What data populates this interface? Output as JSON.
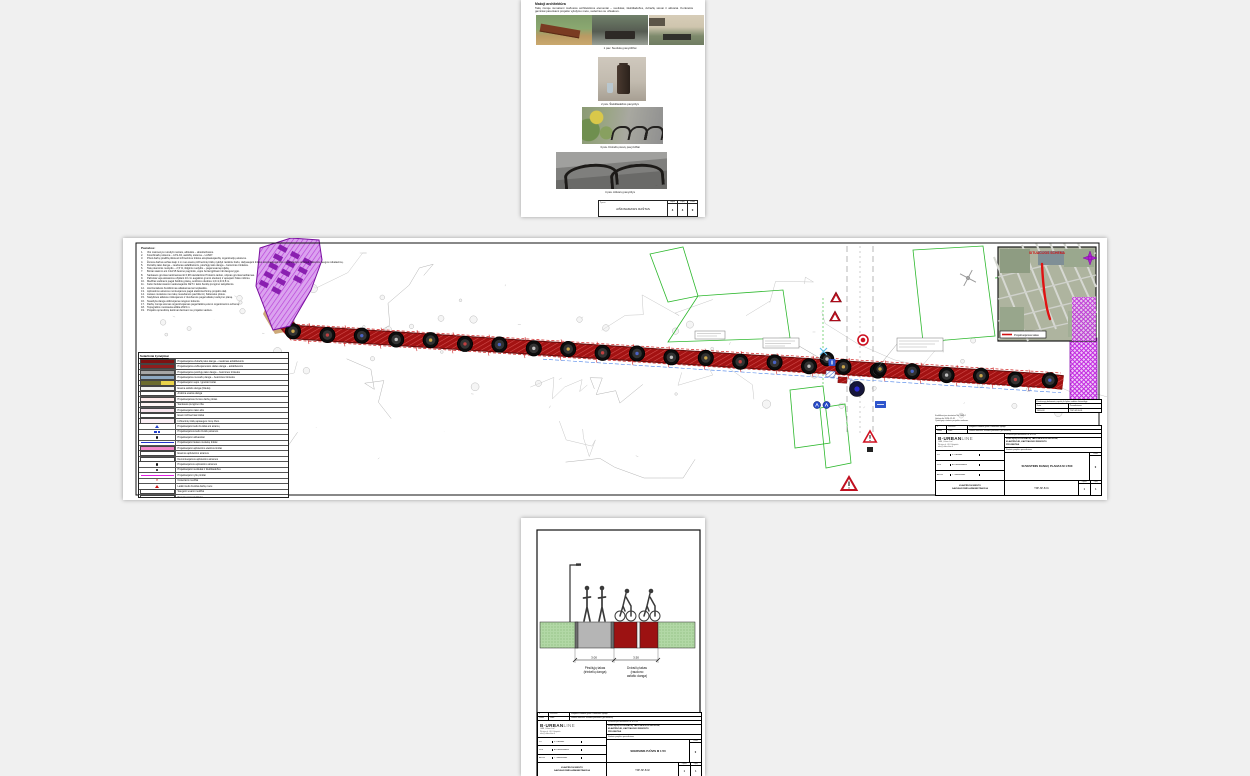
{
  "page1": {
    "heading": "Mažoji architektūra",
    "para": "Takų zonoje numatomi mažosios architektūros elementai – suoliukai, šiukšliadėžės, dviračių stovai ir atitvarai. Konkretūs gaminiai parenkami projekto vykdymo metu, suderinus su užsakovu.",
    "captions": [
      "1 pav. Suoliukų pavyzdžiai",
      "2 pav. Šiukšliadėžės pavyzdys",
      "3 pav. Dviračių stovų pavyzdžiai",
      "4 pav. Atitvarų pavyzdys"
    ],
    "footer": {
      "mark": "Žymuo",
      "doc": "AIŠKINAMASIS RAŠTAS",
      "cols": [
        {
          "k": "Lapas",
          "v": "4"
        },
        {
          "k": "Lapų",
          "v": "4"
        },
        {
          "k": "Laida",
          "v": "0"
        }
      ]
    }
  },
  "page2": {
    "notes_title": "Pastabos:",
    "notes": [
      "Visi matmenys nurodyti metrais, altitudės – absoliučiosios.",
      "Koordinačių sistema – LKS-94, aukščių sistema – LAS07.",
      "Prieš darbų pradžią iškviesti inžinerinius tinklus eksploatuojančių organizacijų atstovus.",
      "Žemės darbus arčiau kaip 1 m nuo esamų inžinerinių tinklų vykdyti rankiniu būdu, dalyvaujant tinklus eksploatuojančios organizacijos atstovui, laikantis saugos reikalavimų.",
      "Dviračių tako danga – raudonas asfaltbetonis, pėsčiųjų tako danga – betoninės trinkelės.",
      "Takų skersinis nuolydis – 2,5 %, išilginis nuolydis – pagal esamą reljefą.",
      "Bortai statomi ant C12/15 betono pagrindo, vejos bortai įgilinami iki dangos lygio.",
      "Sankasos gruntas tankinamas iki 0,98 standartinio Proktoro tankio, silpnas gruntas keičiamas.",
      "Pažeista veja atstatoma užpilant 10 cm augalinio grunto sluoksnį ir apsėjant žolės mišiniu.",
      "Medžiai sodinami pagal želdinių planą, sodinimo duobės 1,0×1,0×0,8 m.",
      "Kelio ženklai statomi vadovaujantis KET ir kelio ženklų įrengimo taisyklėmis.",
      "Horizontalusis ženklinimas atliekamas termoplastiku.",
      "Apšvietimo atramos montuojamos pagal elektrotechninę projekto dalį.",
      "Lietaus nuotekos nuo takų nuvedamos paviršiumi į žaliuosius plotus.",
      "Statybinės atliekos rūšiuojamos ir išvežamos pagal atliekų tvarkymo planą.",
      "Nuardyta danga utilizuojama rangovo lėšomis.",
      "Darbų zonoje eismas organizuojamas pagal laikiną eismo organizavimo schemą.",
      "Topografinė nuotrauka atlikta 2023 m.",
      "Projekto sprendinių keitimai derinami su projekto vadovu."
    ],
    "legend_title": "Sutartiniai žymėjimai",
    "legend": [
      {
        "y": "band",
        "c": "#7d1111",
        "t": "Projektuojama dviračių tako danga – raudonas asfaltbetonis"
      },
      {
        "y": "band",
        "c": "#8f1d1d",
        "t": "Projektuojama važiuojamosios dalies danga – asfaltbetonis"
      },
      {
        "y": "band",
        "c": "#a6a6a6",
        "t": "Projektuojama pėsčiųjų tako danga – betoninės trinkelės"
      },
      {
        "y": "band",
        "c": "#8fa9c2",
        "t": "Projektuojama nuovažų danga – betoninės trinkelės"
      },
      {
        "y": "split",
        "c": "#6b6b2f",
        "c2": "#e8d24a",
        "t": "Projektuojami vejos / granito bortai"
      },
      {
        "y": "band",
        "c": "#efefef",
        "t": "Esama asfalto danga (išlieka)"
      },
      {
        "y": "band",
        "c": "#ffffff",
        "t": "Ardoma esama danga"
      },
      {
        "y": "band",
        "c": "#fdeaea",
        "t": "Projektuojamas žemės darbų plotas"
      },
      {
        "y": "band",
        "c": "#fff4f4",
        "t": "Sankasos įrengimo riba"
      },
      {
        "y": "band",
        "c": "#f6e3ec",
        "t": "Projektuojamo tako ašis"
      },
      {
        "y": "band",
        "c": "#ffffff",
        "t": "Esami inžineriniai tinklai"
      },
      {
        "y": "band",
        "c": "#fbeff5",
        "t": "Inžinerinių tinklų apsaugos zonų ribos"
      },
      {
        "y": "btri",
        "t": "Projektuojami kelio ženklai ant atramų"
      },
      {
        "y": "bdots",
        "t": "Projektuojamos kelio ženklų atramos"
      },
      {
        "y": "dot",
        "t": "Projektuojami atitvarėliai"
      },
      {
        "y": "line",
        "c": "#2233cc",
        "t": "Projektuojami lietaus nuotekų tinklai"
      },
      {
        "y": "band",
        "c": "#f387c9",
        "t": "Projektuojami apšvietimo elektros tinklai"
      },
      {
        "y": "band",
        "c": "#ffffff",
        "t": "Esamos apšvietimo atramos"
      },
      {
        "y": "band",
        "c": "#ffffff",
        "t": "Demontuojamos apšvietimo atramos"
      },
      {
        "y": "dot",
        "t": "Projektuojamos apšvietimo atramos"
      },
      {
        "y": "dot",
        "t": "Projektuojami suoliukai ir šiukšliadėžės"
      },
      {
        "y": "line",
        "c": "#e020e0",
        "t": "Projektuojami ryšių tinklai"
      },
      {
        "y": "x",
        "t": "Nukertami medžiai"
      },
      {
        "y": "rtri",
        "t": "Laikini kelio ženklai darbų metu"
      },
      {
        "y": "band",
        "c": "#ffffff",
        "t": "Saugomi esami medžiai"
      },
      {
        "y": "band",
        "c": "#ffffff",
        "t": "Projektuojami želdiniai"
      },
      {
        "y": "line",
        "c": "#4ad84a",
        "t": "Projektuojama veja"
      },
      {
        "y": "rdash",
        "t": "Darbų zonos riba"
      },
      {
        "y": "band",
        "c": "#b45fe8",
        "t": "Griaunami / rekonstruojami statiniai"
      }
    ],
    "map": {
      "title": "SITUACIJOS SCHEMA",
      "legend": "Projektuojamas takas"
    },
    "attest_lines": [
      "Kvalifikacijos atestatas Nr. 26814",
      "Galioja iki 2026-12-31",
      "Ypatingojo statinio projekto vadovas"
    ],
    "minitable": {
      "title": "Privalomųjų dokumentų sąrašą žr. bylos sudėties žiniaraštyje",
      "h1": "Data",
      "h2": "Pavadinimas",
      "v1": "2024-03",
      "v2": "TDP-SP-B.01"
    },
    "tb": {
      "rev": "0",
      "rev_date": "2024-03",
      "rev_note": "Statybos leidimui gauti ir darbams vykdyti",
      "laida_h": "Laida",
      "data_h": "Data",
      "status_h": "Laidos statusas. Keitimo priežastis (jei taikoma)",
      "logo_a": "B·URBAN",
      "logo_b": "LINE",
      "addr": [
        "UAB „Urban line“",
        "Šilutės pl. 48, Klaipėda",
        "info@urbanline.lt"
      ],
      "attest": "Kvalifikacijos dokumento Nr. A 1234",
      "project": [
        "PĖSČIŲJŲ IR DVIRAČIŲ TAKO ALĖJOS GATVĖJE,",
        "KLAIPĖDOJE, KAPITALINIO REMONTO",
        "PROJEKTAS"
      ],
      "object": "Statinio projekto pavadinimas",
      "roles": [
        [
          "PV",
          "V. Urbonas"
        ],
        [
          "PDV",
          "A. Kazlauskienė"
        ],
        [
          "ARCH",
          "T. Jankauskas"
        ]
      ],
      "title": "SUVESTINIS DANGŲ PLANAS M 1:500",
      "laida_v": "0",
      "org": [
        "KLAIPĖDOS MIESTO",
        "SAVIVALDYBĖS ADMINISTRACIJA"
      ],
      "code": "TDP-SP-B.01",
      "lapas_h": "Lapas",
      "lapu_h": "Lapų",
      "lapas": "1",
      "lapu": "1"
    }
  },
  "page3": {
    "dims": [
      "3.00",
      "3.50"
    ],
    "left_label": [
      "Pėsčiųjų takas",
      "(trinkelių danga)"
    ],
    "right_label": [
      "Dviračių takas",
      "(raudono",
      "asfalto danga)"
    ],
    "tb": {
      "rev": "0",
      "rev_date": "2024-03",
      "rev_note": "Statybos leidimui gauti ir darbams vykdyti",
      "laida_h": "Laida",
      "data_h": "Data",
      "status_h": "Laidos statusas. Keitimo priežastis (jei taikoma)",
      "logo_a": "B·URBAN",
      "logo_b": "LINE",
      "addr": [
        "UAB „Urban line“",
        "Šilutės pl. 48, Klaipėda",
        "info@urbanline.lt"
      ],
      "attest": "Kvalifikacijos dokumento Nr. A 1234",
      "project": [
        "PĖSČIŲJŲ IR DVIRAČIŲ TAKO ALĖJOS GATVĖJE,",
        "KLAIPĖDOJE, KAPITALINIO REMONTO",
        "PROJEKTAS"
      ],
      "object": "Statinio projekto pavadinimas",
      "roles": [
        [
          "PV",
          "V. Urbonas"
        ],
        [
          "PDV",
          "A. Kazlauskienė"
        ],
        [
          "ARCH",
          "T. Jankauskas"
        ]
      ],
      "title": "SKERSINIS PJŪVIS M 1:50",
      "laida_v": "0",
      "org": [
        "KLAIPĖDOS MIESTO",
        "SAVIVALDYBĖS ADMINISTRACIJA"
      ],
      "code": "TDP-SP-B.02",
      "lapas_h": "Lapas",
      "lapu_h": "Lapų",
      "lapas": "1",
      "lapu": "1"
    }
  }
}
